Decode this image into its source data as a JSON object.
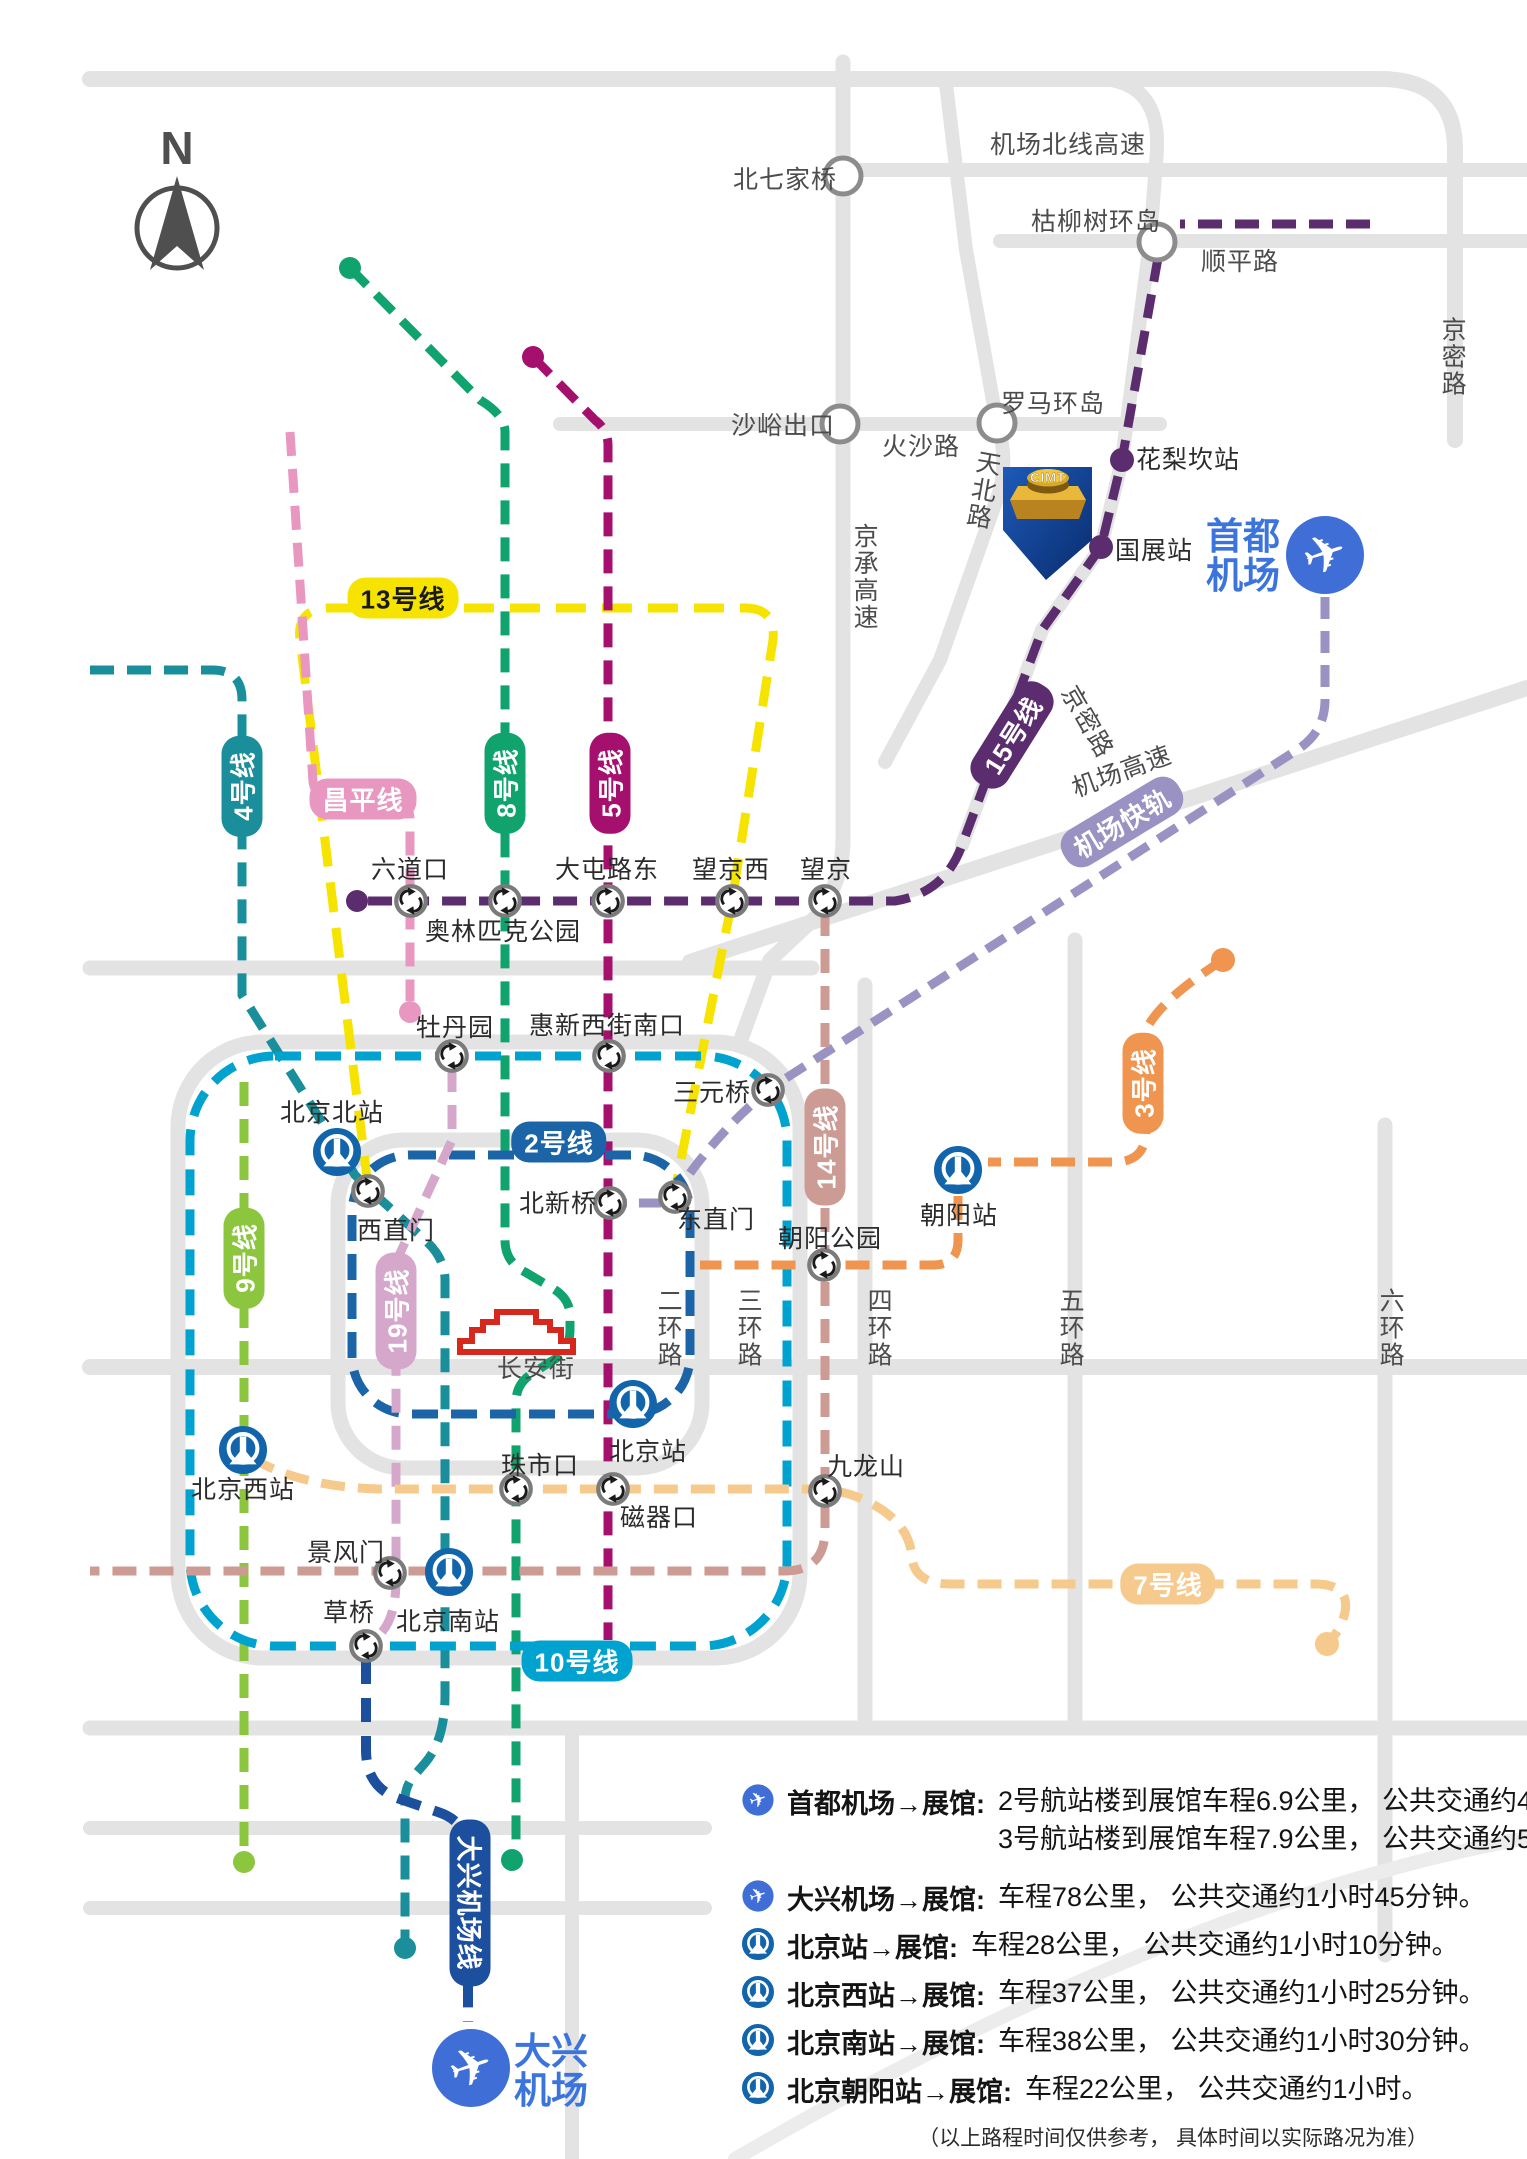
{
  "compass": {
    "letter": "N"
  },
  "colors": {
    "road": "#e3e3e3",
    "road_node_stroke": "#8c8c8c",
    "line4": "#1a8f9b",
    "line9": "#8cc63f",
    "line13": "#f6e400",
    "changping": "#e898c0",
    "line8": "#10a36d",
    "line5": "#a5106e",
    "line15": "#5b2d6e",
    "line2": "#1b64a8",
    "line10": "#00a3cf",
    "line19": "#d5a8cb",
    "line14": "#cc9b94",
    "line3": "#f0954f",
    "line7": "#f6c98d",
    "airport_express": "#9a92c2",
    "daxing_line": "#1c4f9e",
    "airport_blue": "#3f6fd6",
    "rail_blue": "#1265ab",
    "cimt_flag_blue": "#123f8f",
    "landmark_red": "#d6281c"
  },
  "line_labels": {
    "line13": "13号线",
    "line4": "4号线",
    "changping": "昌平线",
    "line8": "8号线",
    "line5": "5号线",
    "line15": "15号线",
    "airport_express": "机场快轨",
    "line2": "2号线",
    "line9": "9号线",
    "line19": "19号线",
    "line14": "14号线",
    "line3": "3号线",
    "line10": "10号线",
    "line7": "7号线",
    "daxing_line": "大兴机场线"
  },
  "roads": {
    "jichang_beixian": "机场北线高速",
    "beiqijiaqiao": "北七家桥",
    "kuliushu": "枯柳树环岛",
    "shunping": "顺平路",
    "shayu": "沙峪出口",
    "huosha": "火沙路",
    "luoma": "罗马环岛",
    "tianbei": "天北路",
    "jingmi_top": "京密路",
    "jingmi_mid": "京密路",
    "jingcheng": "京承高速",
    "jichang_gaosu": "机场高速",
    "ring2": "二环路",
    "ring3": "三环路",
    "ring4": "四环路",
    "ring5": "五环路",
    "ring6": "六环路",
    "changan": "长安街"
  },
  "stations": {
    "hualikan": "花梨坎站",
    "guozhan": "国展站",
    "liudaokou": "六道口",
    "olympic": "奥林匹克公园",
    "datunludong": "大屯路东",
    "wangjingxi": "望京西",
    "wangjing": "望京",
    "mudanyuan": "牡丹园",
    "huixinxijie": "惠新西街南口",
    "sanyuanqiao": "三元桥",
    "beijingbei": "北京北站",
    "xizhimen": "西直门",
    "beixinqiao": "北新桥",
    "dongzhimen": "东直门",
    "chaoyangpark": "朝阳公园",
    "chaoyang": "朝阳站",
    "zhushikou": "珠市口",
    "ciqikou": "磁器口",
    "jiulongshan": "九龙山",
    "beijing": "北京站",
    "beijingxi": "北京西站",
    "jingfengmen": "景风门",
    "caoqiao": "草桥",
    "beijingnan": "北京南站"
  },
  "landmarks": {
    "cimt": "CIMT"
  },
  "airports": {
    "capital": {
      "line1": "首都",
      "line2": "机场"
    },
    "daxing": {
      "line1": "大兴",
      "line2": "机场"
    }
  },
  "legend": {
    "rows": [
      {
        "icon": "plane",
        "name": "首都机场→展馆:",
        "desc": "2号航站楼到展馆车程6.9公里， 公共交通约45分钟。",
        "desc2": "3号航站楼到展馆车程7.9公里， 公共交通约55分钟。"
      },
      {
        "icon": "plane",
        "name": "大兴机场→展馆:",
        "desc": "车程78公里， 公共交通约1小时45分钟。"
      },
      {
        "icon": "rail",
        "name": "北京站→展馆:",
        "desc": "车程28公里， 公共交通约1小时10分钟。"
      },
      {
        "icon": "rail",
        "name": "北京西站→展馆:",
        "desc": "车程37公里， 公共交通约1小时25分钟。"
      },
      {
        "icon": "rail",
        "name": "北京南站→展馆:",
        "desc": "车程38公里， 公共交通约1小时30分钟。"
      },
      {
        "icon": "rail",
        "name": "北京朝阳站→展馆:",
        "desc": "车程22公里， 公共交通约1小时。"
      }
    ],
    "footer": "（以上路程时间仅供参考， 具体时间以实际路况为准）"
  }
}
